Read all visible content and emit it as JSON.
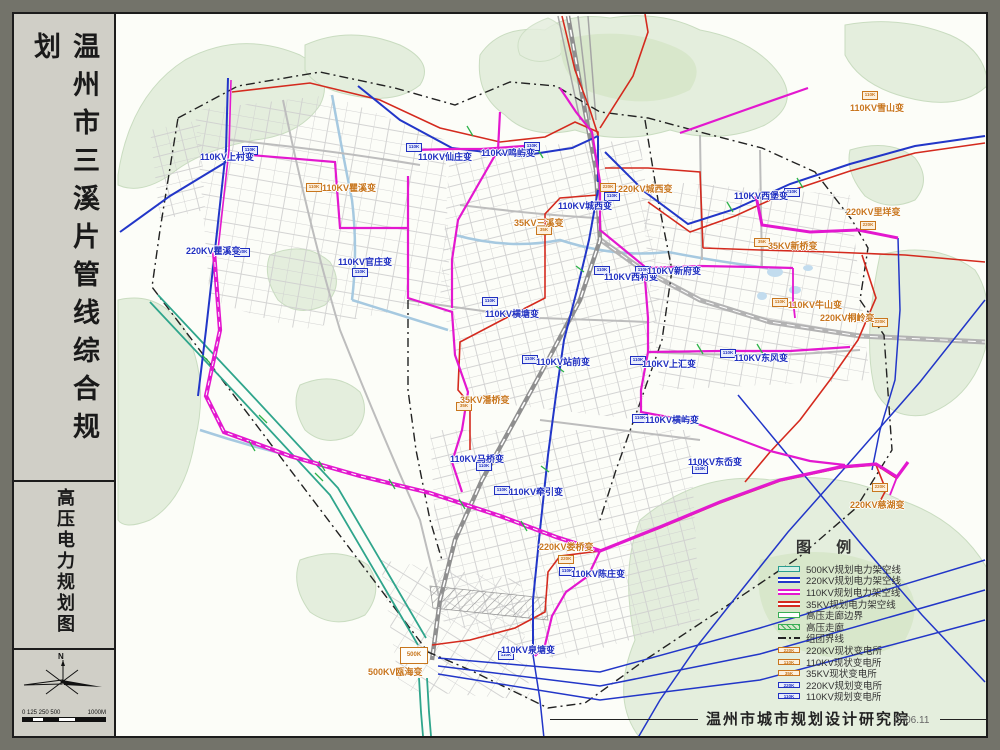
{
  "sidebar": {
    "main_title": "温州市三溪片管线综合规划",
    "sub_title": "高压电力规划图",
    "north_label": "N",
    "scale_left": "0 125 250 500",
    "scale_right": "1000M"
  },
  "map": {
    "legend": {
      "title": "图  例",
      "items": [
        {
          "swatch": "bar-fill",
          "label": "500KV规划电力架空线",
          "color": "#2a9d8f",
          "fill": "#d6f0e6"
        },
        {
          "swatch": "bar-line",
          "label": "220KV规划电力架空线",
          "color": "#2236c8"
        },
        {
          "swatch": "bar-line",
          "label": "110KV规划电力架空线",
          "color": "#e318cf"
        },
        {
          "swatch": "bar-line",
          "label": "35KV规划电力架空线",
          "color": "#d42a1e"
        },
        {
          "swatch": "bar-fill",
          "label": "高压走廊边界",
          "color": "#3aae55",
          "fill": "#ffffff"
        },
        {
          "swatch": "hatch",
          "label": "高压走廊",
          "color": "#3aae55"
        },
        {
          "swatch": "dashdot",
          "label": "组团界线",
          "color": "#222222"
        },
        {
          "swatch": "station",
          "label": "220KV现状变电所",
          "color": "#c8761d",
          "fill": "#fcf0de",
          "text": "220K"
        },
        {
          "swatch": "station",
          "label": "110KV现状变电所",
          "color": "#c8761d",
          "fill": "#fcf0de",
          "text": "110K"
        },
        {
          "swatch": "station",
          "label": "35KV现状变电所",
          "color": "#c8761d",
          "fill": "#fcf0de",
          "text": "35K"
        },
        {
          "swatch": "station",
          "label": "220KV规划变电所",
          "color": "#2030c0",
          "fill": "#e8edfc",
          "text": "220K"
        },
        {
          "swatch": "station",
          "label": "110KV规划变电所",
          "color": "#2030c0",
          "fill": "#e8edfc",
          "text": "110K"
        }
      ]
    },
    "station_types": {
      "e500": {
        "box": "500K",
        "status": "existing"
      },
      "e220": {
        "box": "220K",
        "status": "existing"
      },
      "e110": {
        "box": "110K",
        "status": "existing"
      },
      "e35": {
        "box": "35K",
        "status": "existing"
      },
      "p220": {
        "box": "220K",
        "status": "planned"
      },
      "p110": {
        "box": "110K",
        "status": "planned"
      }
    },
    "substations": [
      {
        "text": "110KV上村变",
        "x": 200,
        "y": 150,
        "bx": 242,
        "by": 146,
        "type": "p110"
      },
      {
        "text": "110KV瞿溪变",
        "x": 322,
        "y": 181,
        "bx": 306,
        "by": 183,
        "type": "e110"
      },
      {
        "text": "220KV瞿溪变",
        "x": 186,
        "y": 244,
        "bx": 234,
        "by": 248,
        "type": "p220"
      },
      {
        "text": "110KV官庄变",
        "x": 338,
        "y": 255,
        "bx": 352,
        "by": 268,
        "type": "p110"
      },
      {
        "text": "110KV仙庄变",
        "x": 418,
        "y": 150,
        "bx": 406,
        "by": 143,
        "type": "p110"
      },
      {
        "text": "110KV鸣屿变",
        "x": 481,
        "y": 146,
        "bx": 524,
        "by": 142,
        "type": "p110"
      },
      {
        "text": "220KV城西变",
        "x": 618,
        "y": 182,
        "bx": 600,
        "by": 183,
        "type": "e220"
      },
      {
        "text": "110KV城西变",
        "x": 558,
        "y": 199,
        "bx": 604,
        "by": 192,
        "type": "p110"
      },
      {
        "text": "35KV三溪变",
        "x": 514,
        "y": 216,
        "bx": 536,
        "by": 226,
        "type": "e35"
      },
      {
        "text": "110KV西村变",
        "x": 604,
        "y": 270,
        "bx": 594,
        "by": 266,
        "type": "p110"
      },
      {
        "text": "110KV新府变",
        "x": 647,
        "y": 264,
        "bx": 635,
        "by": 266,
        "type": "p110"
      },
      {
        "text": "110KV牛山变",
        "x": 788,
        "y": 298,
        "bx": 772,
        "by": 298,
        "type": "e110"
      },
      {
        "text": "220KV桐岭变",
        "x": 820,
        "y": 311,
        "bx": 872,
        "by": 318,
        "type": "e220"
      },
      {
        "text": "110KV东风变",
        "x": 734,
        "y": 351,
        "bx": 720,
        "by": 349,
        "type": "p110"
      },
      {
        "text": "110KV上汇变",
        "x": 642,
        "y": 357,
        "bx": 630,
        "by": 356,
        "type": "p110"
      },
      {
        "text": "110KV站前变",
        "x": 536,
        "y": 355,
        "bx": 522,
        "by": 355,
        "type": "p110"
      },
      {
        "text": "110KV横塘变",
        "x": 485,
        "y": 307,
        "bx": 482,
        "by": 297,
        "type": "p110"
      },
      {
        "text": "35KV潘桥变",
        "x": 460,
        "y": 393,
        "bx": 456,
        "by": 402,
        "type": "e35"
      },
      {
        "text": "110KV横屿变",
        "x": 645,
        "y": 413,
        "bx": 632,
        "by": 414,
        "type": "p110"
      },
      {
        "text": "110KV东岙变",
        "x": 688,
        "y": 455,
        "bx": 692,
        "by": 465,
        "type": "p110"
      },
      {
        "text": "110KV马桥变",
        "x": 450,
        "y": 452,
        "bx": 476,
        "by": 462,
        "type": "p110"
      },
      {
        "text": "110KV牵引变",
        "x": 509,
        "y": 485,
        "bx": 494,
        "by": 486,
        "type": "p110"
      },
      {
        "text": "220KV娄桥变",
        "x": 539,
        "y": 540,
        "bx": 558,
        "by": 555,
        "type": "e220"
      },
      {
        "text": "110KV陈庄变",
        "x": 571,
        "y": 567,
        "bx": 559,
        "by": 567,
        "type": "p110"
      },
      {
        "text": "110KV泉塘变",
        "x": 501,
        "y": 643,
        "bx": 498,
        "by": 651,
        "type": "p110"
      },
      {
        "text": "500KV瓯海变",
        "x": 368,
        "y": 665,
        "bx": 400,
        "by": 647,
        "type": "e500"
      },
      {
        "text": "110KV雪山变",
        "x": 850,
        "y": 101,
        "bx": 862,
        "by": 91,
        "type": "e110"
      },
      {
        "text": "110KV西堡变",
        "x": 734,
        "y": 189,
        "bx": 784,
        "by": 188,
        "type": "p110"
      },
      {
        "text": "220KV里垟变",
        "x": 846,
        "y": 205,
        "bx": 860,
        "by": 221,
        "type": "e220"
      },
      {
        "text": "35KV新桥变",
        "x": 768,
        "y": 239,
        "bx": 754,
        "by": 238,
        "type": "e35"
      },
      {
        "text": "220KV慈湖变",
        "x": 850,
        "y": 498,
        "bx": 872,
        "by": 483,
        "type": "e220"
      }
    ],
    "attribution": {
      "org": "温州市城市规划设计研究院",
      "date": "2006.11"
    }
  },
  "colors": {
    "kv500": "#2a9d8f",
    "kv220": "#2236c8",
    "kv110": "#e318cf",
    "kv35": "#d42a1e",
    "existing_text": "#c8761d",
    "planned_text": "#2030c0",
    "hills": "#e4eedd",
    "water": "#a6c9e0",
    "frame": "#73736a",
    "sidebar_bg": "#d0cfc7"
  }
}
